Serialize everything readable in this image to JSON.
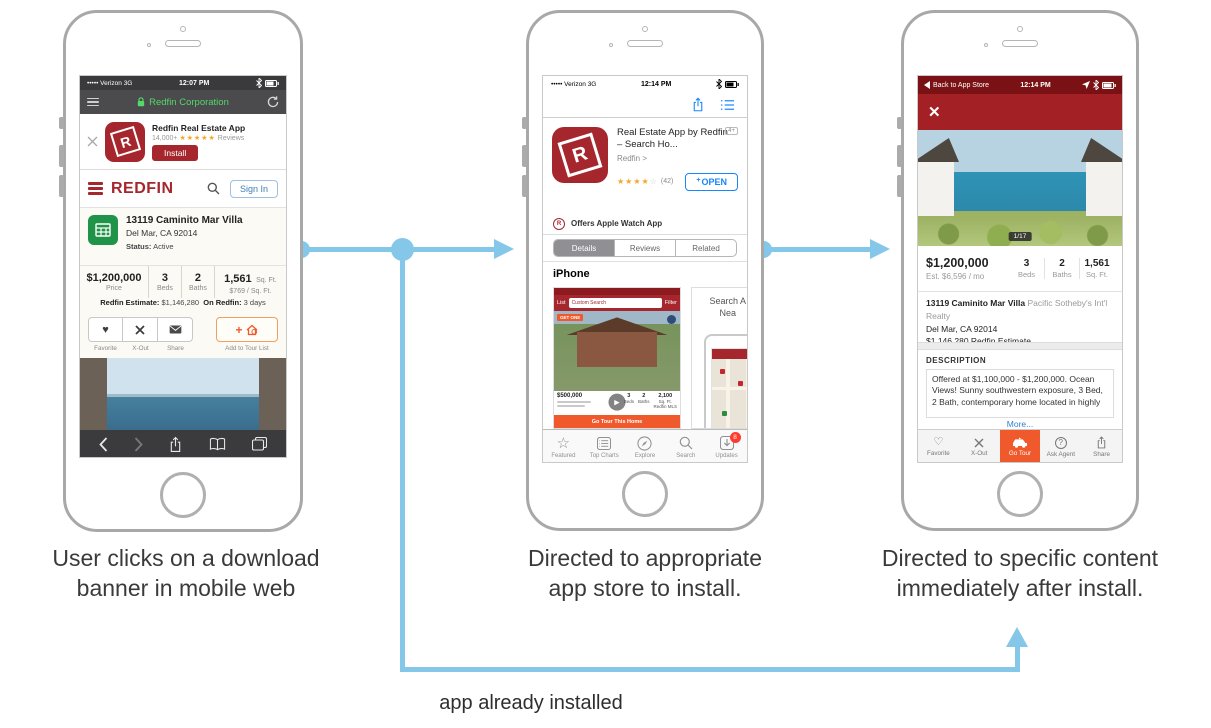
{
  "captions": {
    "step1_line1": "User clicks on a download",
    "step1_line2": "banner in mobile web",
    "step2_line1": "Directed to appropriate",
    "step2_line2": "app store to install.",
    "step3_line1": "Directed to specific content",
    "step3_line2": "immediately after install.",
    "bottom": "app already installed"
  },
  "colors": {
    "arrow": "#85c7e8",
    "redfin_red": "#a6262e",
    "orange": "#f0592b",
    "ios_blue": "#1787fb",
    "header_red": "#a32025"
  },
  "phone1": {
    "status": {
      "carrier": "••••• Verizon",
      "network": "3G",
      "time": "12:07 PM"
    },
    "urlbar": {
      "site": "Redfin Corporation"
    },
    "banner": {
      "app_name": "Redfin Real Estate App",
      "rating_count": "14,000+",
      "stars": "★★★★★",
      "reviews_label": "Reviews",
      "install_label": "Install",
      "app_letter": "R"
    },
    "header": {
      "logo": "REDFIN",
      "signin_label": "Sign In"
    },
    "listing": {
      "address": "13119 Caminito Mar Villa",
      "city": "Del Mar, CA 92014",
      "status_label": "Status:",
      "status_value": "Active",
      "stats": [
        {
          "value": "$1,200,000",
          "label": "Price"
        },
        {
          "value": "3",
          "label": "Beds"
        },
        {
          "value": "2",
          "label": "Baths"
        },
        {
          "value": "1,561",
          "unit": "Sq. Ft.",
          "label": "$769 / Sq. Ft."
        }
      ],
      "estimate_label": "Redfin Estimate:",
      "estimate_value": "$1,146,280",
      "on_redfin_label": "On Redfin:",
      "on_redfin_value": "3 days"
    },
    "actions": [
      {
        "label": "Favorite"
      },
      {
        "label": "X-Out"
      },
      {
        "label": "Share"
      },
      {
        "label": "Add to Tour List"
      }
    ]
  },
  "phone2": {
    "status": {
      "carrier": "••••• Verizon",
      "network": "3G",
      "time": "12:14 PM"
    },
    "app": {
      "title": "Real Estate App by Redfin – Search Ho...",
      "developer": "Redfin >",
      "age_badge": "4+",
      "stars": "★★★★",
      "star_empty": "☆",
      "rating_count": "(42)",
      "open_plus": "+",
      "open_label": "OPEN",
      "app_letter": "R"
    },
    "watch_icon_letter": "R",
    "watch_label": "Offers Apple Watch App",
    "tabs": [
      {
        "label": "Details"
      },
      {
        "label": "Reviews"
      },
      {
        "label": "Related"
      }
    ],
    "section_label": "iPhone",
    "screenshot": {
      "list_label": "List",
      "search_text": "Custom Search",
      "filter_label": "Filter",
      "promo": "GET ONE",
      "price": "$500,000",
      "beds": "3",
      "beds_label": "Beds",
      "baths": "2",
      "baths_label": "Baths",
      "sqft": "2,100",
      "sqft_label": "Sq. Ft.",
      "mls": "Redfin MLS",
      "play": "▶",
      "tour_button": "Go Tour This Home"
    },
    "screenshot2": {
      "title_line1": "Search A",
      "title_line2": "Nea"
    },
    "tabbar": [
      {
        "label": "Featured"
      },
      {
        "label": "Top Charts"
      },
      {
        "label": "Explore"
      },
      {
        "label": "Search"
      },
      {
        "label": "Updates",
        "badge": "8"
      }
    ]
  },
  "phone3": {
    "status": {
      "back": "Back to App Store",
      "time": "12:14 PM"
    },
    "close": "✕",
    "photo_counter": "1/17",
    "summary": {
      "price": "$1,200,000",
      "est": "Est. $6,596 / mo",
      "stats": [
        {
          "value": "3",
          "label": "Beds"
        },
        {
          "value": "2",
          "label": "Baths"
        },
        {
          "value": "1,561",
          "label": "Sq. Ft."
        }
      ]
    },
    "address": {
      "street": "13119 Caminito Mar Villa",
      "realty": "Pacific Sotheby's Int'l Realty",
      "city": "Del Mar, CA 92014",
      "estimate_value": "$1,146,280",
      "estimate_link": "Redfin Estimate"
    },
    "description": {
      "title": "DESCRIPTION",
      "text": "Offered at $1,100,000 - $1,200,000. Ocean Views! Sunny southwestern exposure, 3 Bed, 2 Bath, contemporary home located in highly",
      "more_link": "More..."
    },
    "tabbar": [
      {
        "label": "Favorite"
      },
      {
        "label": "X-Out"
      },
      {
        "label": "Go Tour"
      },
      {
        "label": "Ask Agent"
      },
      {
        "label": "Share"
      }
    ]
  }
}
